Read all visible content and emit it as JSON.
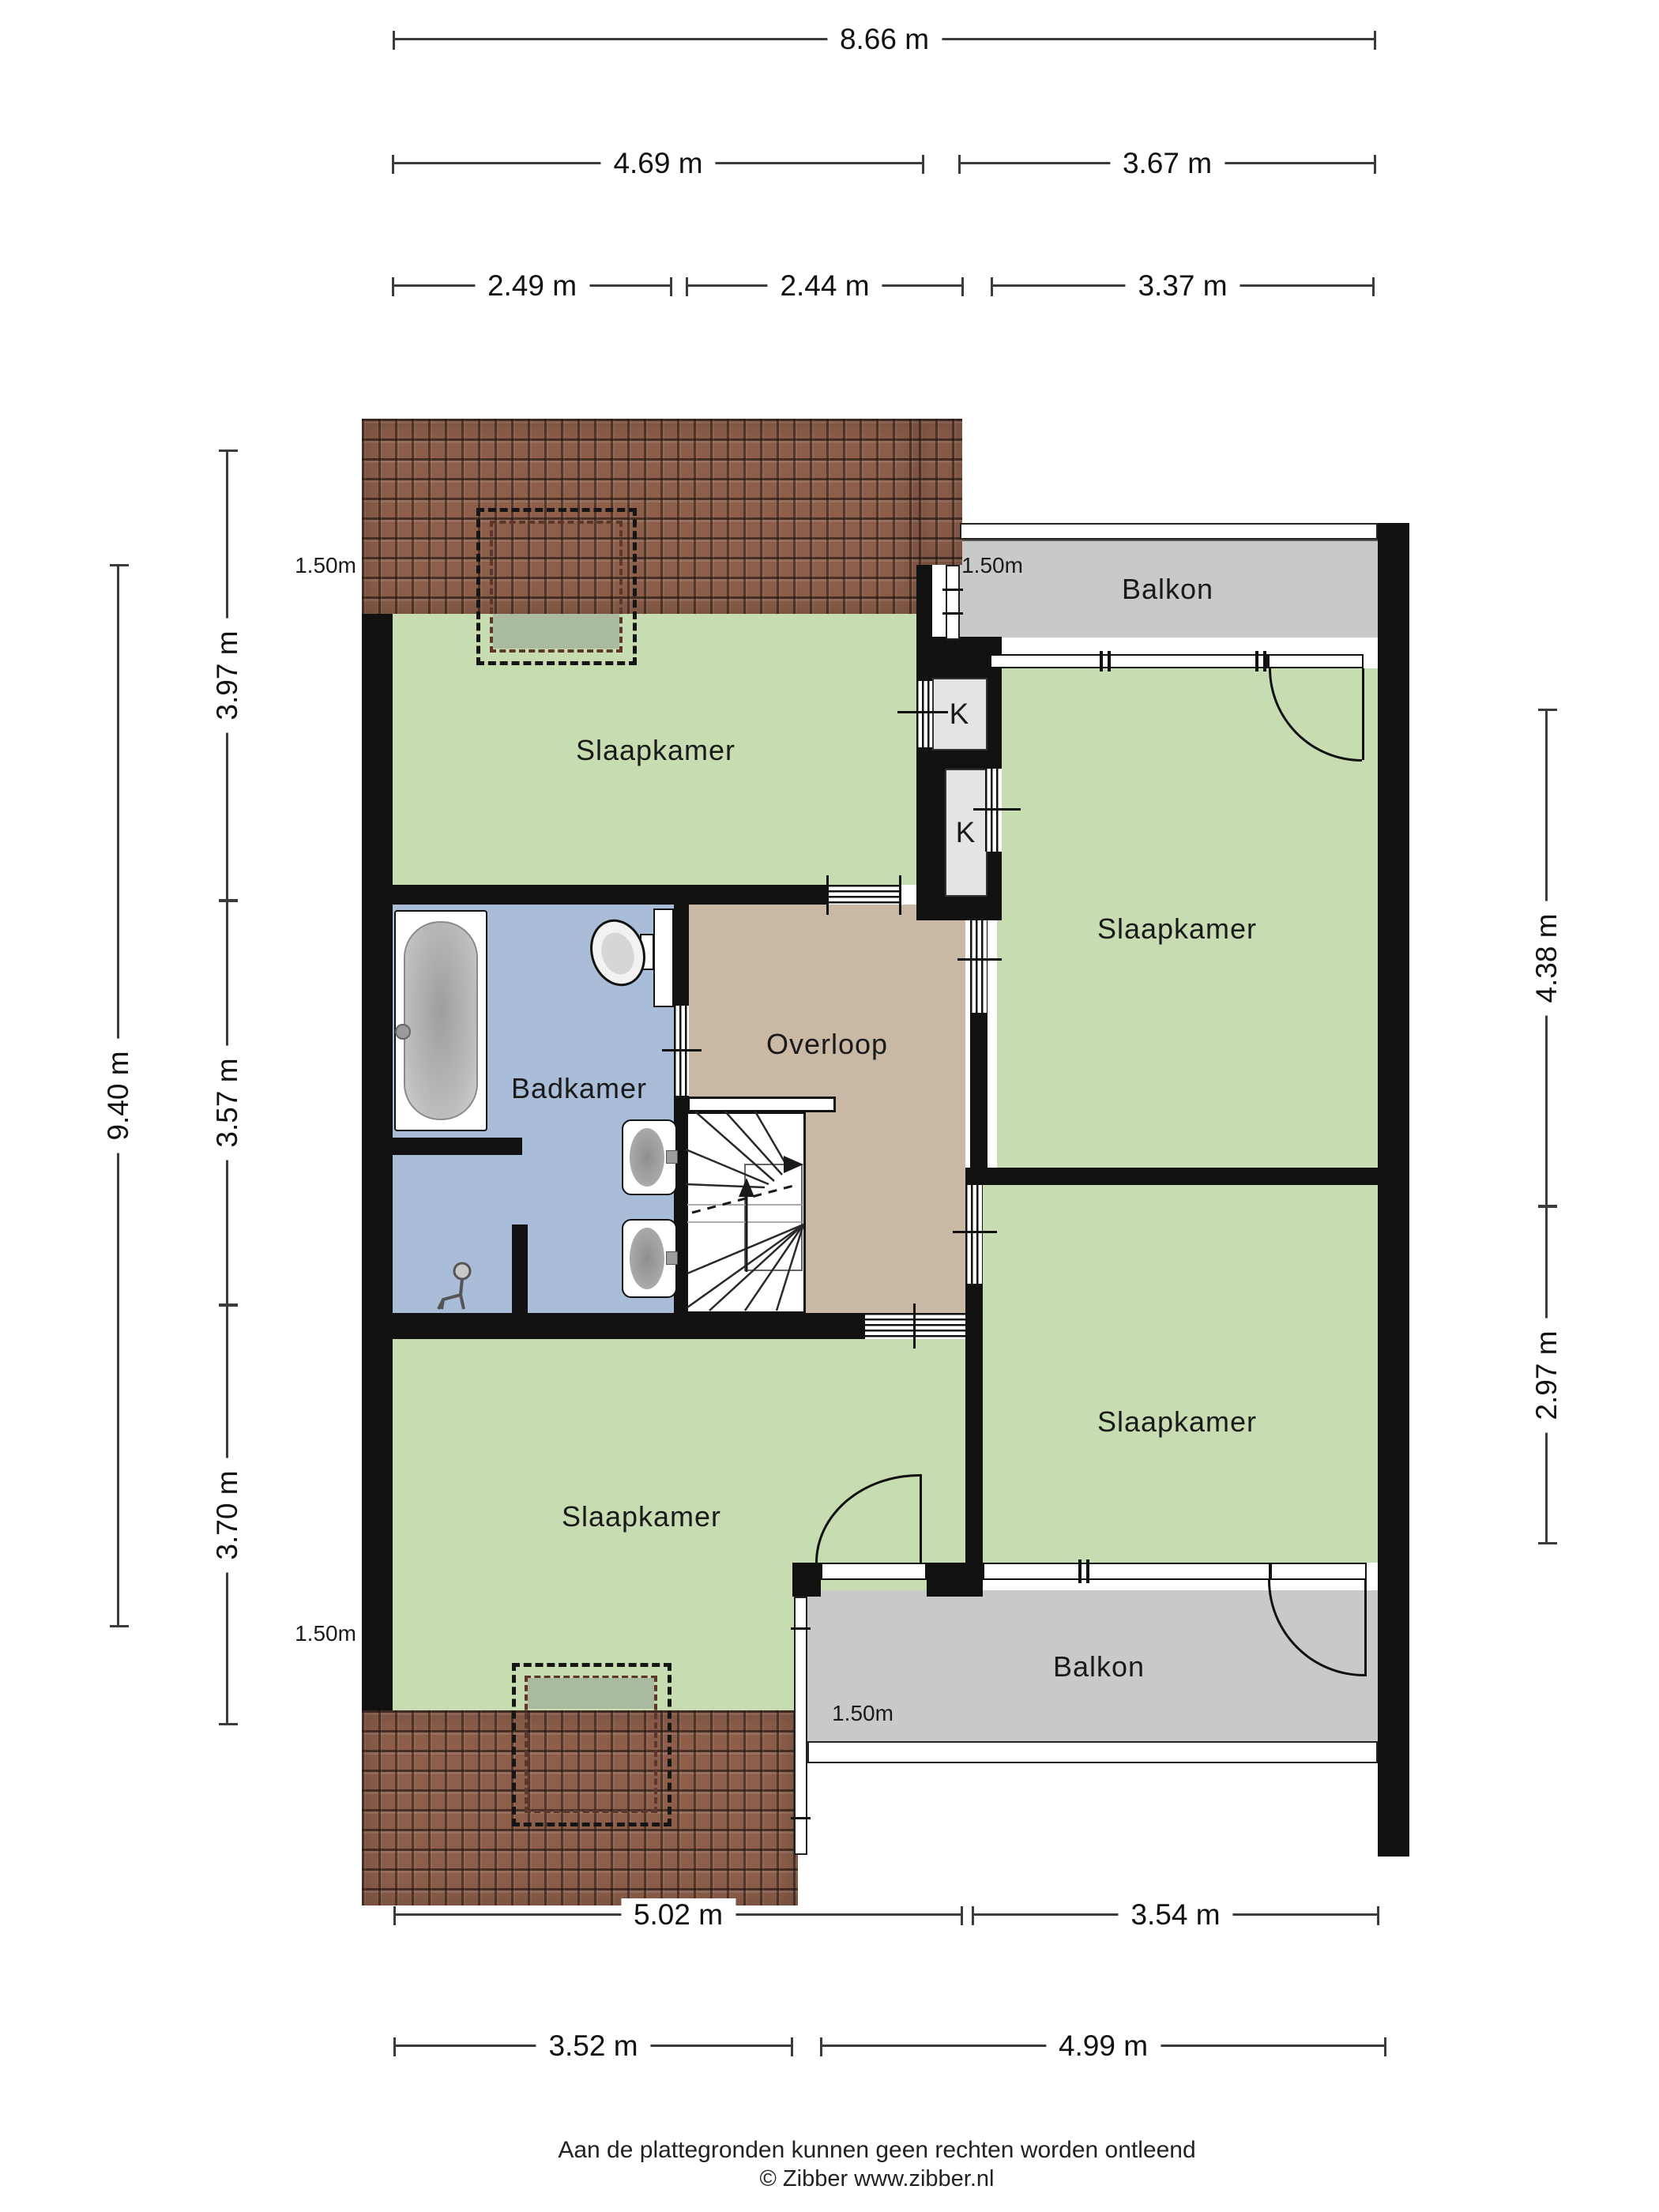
{
  "plan_type": "floorplan",
  "rooms": [
    {
      "id": "slaapkamer-top-left",
      "label": "Slaapkamer"
    },
    {
      "id": "slaapkamer-right",
      "label": "Slaapkamer"
    },
    {
      "id": "slaapkamer-bottom-right",
      "label": "Slaapkamer"
    },
    {
      "id": "slaapkamer-bottom-left",
      "label": "Slaapkamer"
    },
    {
      "id": "badkamer",
      "label": "Badkamer"
    },
    {
      "id": "overloop",
      "label": "Overloop"
    }
  ],
  "closets": [
    {
      "label": "K"
    },
    {
      "label": "K"
    }
  ],
  "balconies": [
    {
      "label": "Balkon"
    },
    {
      "label": "Balkon"
    }
  ],
  "height_markers": [
    {
      "label": "1.50m"
    },
    {
      "label": "1.50m"
    },
    {
      "label": "1.50m"
    },
    {
      "label": "1.50m"
    }
  ],
  "dimensions": {
    "top": [
      {
        "label": "8.66 m"
      },
      {
        "label": "4.69 m"
      },
      {
        "label": "3.67 m"
      },
      {
        "label": "2.49 m"
      },
      {
        "label": "2.44 m"
      },
      {
        "label": "3.37 m"
      }
    ],
    "bottom": [
      {
        "label": "5.02 m"
      },
      {
        "label": "3.54 m"
      },
      {
        "label": "3.52 m"
      },
      {
        "label": "4.99 m"
      }
    ],
    "left": [
      {
        "label": "9.40 m"
      },
      {
        "label": "3.97 m"
      },
      {
        "label": "3.57 m"
      },
      {
        "label": "3.70 m"
      }
    ],
    "right": [
      {
        "label": "4.38 m"
      },
      {
        "label": "2.97 m"
      }
    ]
  },
  "footer": {
    "disclaimer": "Aan de plattegronden kunnen geen rechten worden ontleend",
    "copyright": "© Zibber www.zibber.nl"
  },
  "colors": {
    "room_green": "#c7ddb1",
    "bathroom_blue": "#a9bdd8",
    "landing_tan": "#c8b8a4",
    "balcony_gray": "#c9c9c9",
    "closet_gray": "#e4e4e4",
    "wall_black": "#111111",
    "roof_brown": "#8d5f4b",
    "dormer_fill": "#a9ba9f"
  }
}
